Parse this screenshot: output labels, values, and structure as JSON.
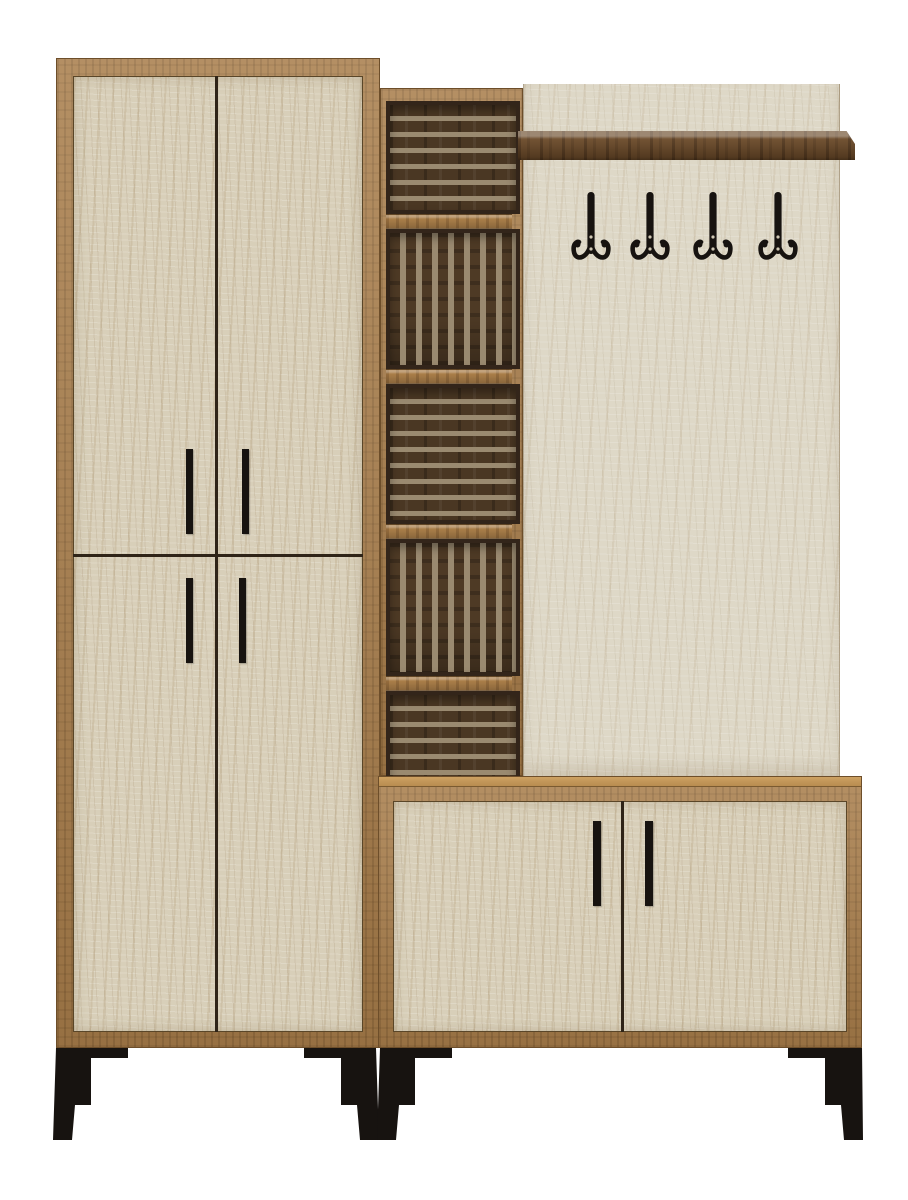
{
  "image": {
    "alt": "Product photo of an entryway hallway furniture set in beige travertine-look panels with oak wood frames: a tall four-door cabinet, a central open column of five slatted cubbies, a coat panel with a walnut shelf and four black double hooks, a low two-door shoe cabinet, and angled black metal legs",
    "background": "#ffffff"
  },
  "palette": {
    "background": "#ffffff",
    "oak_frame": "#a87d4a",
    "oak_light_top": "#c59a5e",
    "oak_dark_edge": "#6d4e2a",
    "walnut_shelf": "#6b4a29",
    "walnut_dark": "#3f2b15",
    "stone_door": "#d8cfb9",
    "stone_panel": "#ded8c7",
    "stone_vein": "#b9a585",
    "slat_dark": "#4a3723",
    "slat_gap": "#9a8a70",
    "metal_black": "#171310",
    "seam_dark": "#2f2418"
  },
  "left_cabinet": {
    "kind": "tall wardrobe cabinet",
    "doors": 4,
    "handles": 4
  },
  "shelf_column": {
    "kind": "open slatted cubby column",
    "compartments": [
      {
        "slats": "horizontal"
      },
      {
        "slats": "vertical"
      },
      {
        "slats": "horizontal"
      },
      {
        "slats": "vertical"
      },
      {
        "slats": "horizontal"
      }
    ]
  },
  "coat_panel": {
    "kind": "coat rack back panel",
    "shelves": 1,
    "hooks": 4
  },
  "bottom_cabinet": {
    "kind": "low shoe cabinet",
    "doors": 2,
    "handles": 2
  },
  "legs": {
    "count": 4,
    "style": "angled black metal with corner brackets"
  }
}
